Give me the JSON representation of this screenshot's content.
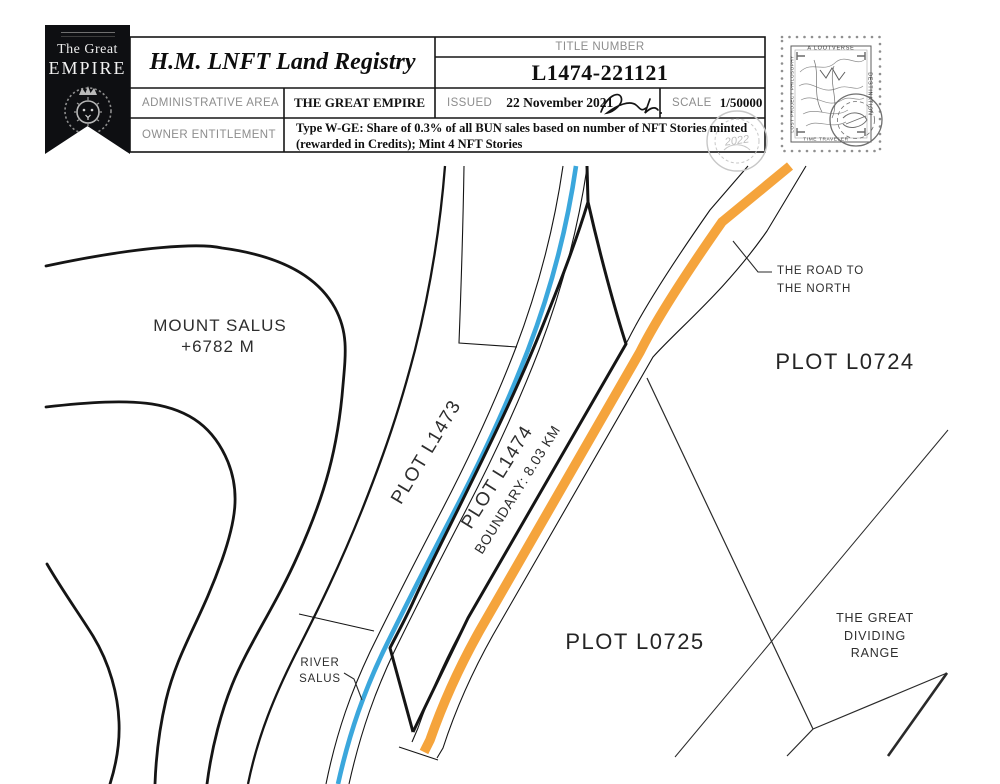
{
  "banner": {
    "line1": "The Great",
    "line2": "EMPIRE"
  },
  "header": {
    "registry_title": "H.M. LNFT Land Registry",
    "title_number_label": "TITLE NUMBER",
    "title_number": "L1474-221121",
    "admin_area_label": "ADMINISTRATIVE AREA",
    "admin_area_value": "THE GREAT EMPIRE",
    "issued_label": "ISSUED",
    "issued_date": "22 November 2021",
    "scale_label": "SCALE",
    "scale_value": "1/50000",
    "owner_label": "OWNER ENTITLEMENT",
    "owner_line1": "Type W-GE: Share of 0.3% of all BUN sales based on number of NFT Stories minted",
    "owner_line2": "(rewarded in Credits); Mint 4 NFT Stories"
  },
  "seal": {
    "year": "2022"
  },
  "stamp": {
    "top_text": "A LOOTVERSE",
    "right_text": "DESTINATION",
    "left_text": "LOST PROJECT PHILOSOPHY",
    "bottom_text": "TIME TRAVELER"
  },
  "map": {
    "mount_line1": "MOUNT SALUS",
    "mount_line2": "+6782 M",
    "plot_l1473": "PLOT L1473",
    "plot_l1474": "PLOT L1474",
    "boundary_length": "BOUNDARY: 8.03 KM",
    "plot_l0724": "PLOT L0724",
    "plot_l0725": "PLOT L0725",
    "river_line1": "RIVER",
    "river_line2": "SALUS",
    "road_line1": "THE ROAD TO",
    "road_line2": "THE NORTH",
    "range_line1": "THE GREAT",
    "range_line2": "DIVIDING",
    "range_line3": "RANGE"
  },
  "colors": {
    "river": "#3BA7DC",
    "road": "#F5A43C",
    "ink": "#151515",
    "muted": "#2E2E2E"
  }
}
